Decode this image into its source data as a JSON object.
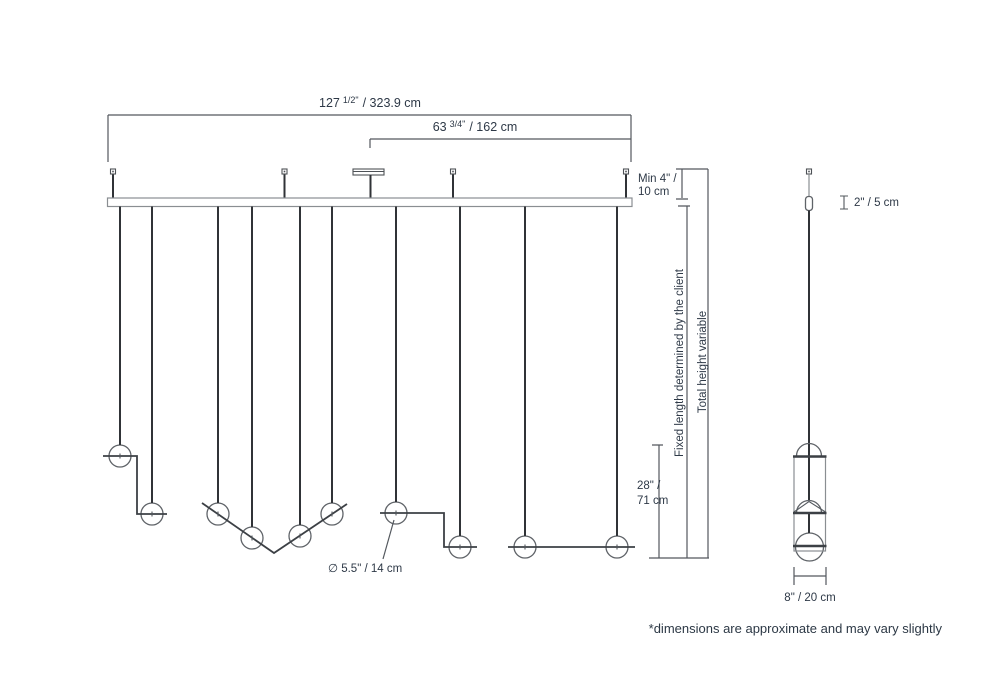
{
  "drawing": {
    "type": "pendant-light-dimension-drawing",
    "views": [
      "front-linear-composition",
      "side-single-pendant"
    ]
  },
  "labels": {
    "dim_overall": {
      "value_main": "127",
      "value_frac": "1/2\"",
      "value_rest": "/ 323.9 cm"
    },
    "dim_center": {
      "value_main": "63",
      "value_frac": "3/4\"",
      "value_rest": "/ 162 cm"
    },
    "dim_min_drop": {
      "line1": "Min 4\" /",
      "line2": "10 cm"
    },
    "dim_fixed_length": "Fixed length determined by the client",
    "dim_total_height": "Total height variable",
    "dim_lower_drop": {
      "line1": "28\" /",
      "line2": "71 cm"
    },
    "dim_globe_diameter": "∅ 5.5\" / 14 cm",
    "dim_stem": "2\" / 5 cm",
    "dim_fixture_width": "8\"  /  20 cm",
    "footnote": "*dimensions are approximate and may vary slightly"
  },
  "colors": {
    "background": "#ffffff",
    "text": "#2e3947",
    "dimension_lines": "#53585e",
    "cables": "#303337",
    "outlines": "#8a8e92"
  }
}
